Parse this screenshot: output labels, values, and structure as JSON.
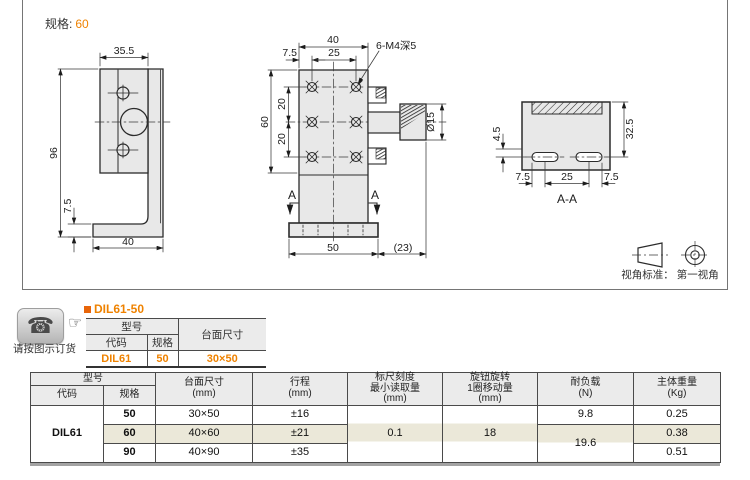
{
  "drawing": {
    "spec_label": "规格:",
    "spec_value": "60",
    "thread_note": "6-M4深5",
    "section_marker": "A",
    "section_label": "A-A",
    "projection_note": "视角标准： 第一视角",
    "dims": {
      "lv_width": "35.5",
      "lv_height": "96",
      "lv_base_th": "7.5",
      "lv_base_w": "40",
      "fv_width": "40",
      "fv_pitch_x": "25",
      "fv_edge": "7.5",
      "fv_height": "60",
      "fv_pitch_y1": "20",
      "fv_pitch_y2": "20",
      "fv_base": "50",
      "fv_knob_ext": "(23)",
      "fv_knob_dia": "Ø15",
      "sv_height": "32.5",
      "sv_offset": "4.5",
      "sv_left": "7.5",
      "sv_pitch": "25",
      "sv_right": "7.5"
    }
  },
  "order": {
    "caption": "请按图示订货",
    "title": "DIL61-50",
    "table": {
      "model": "型号",
      "code": "代码",
      "spec": "规格",
      "size": "台面尺寸",
      "code_value": "DIL61",
      "spec_value": "50",
      "size_value": "30×50"
    }
  },
  "spec_table": {
    "headers": {
      "model": "型号",
      "code": "代码",
      "spec": "规格",
      "size_l1": "台面尺寸",
      "size_l2": "(mm)",
      "travel_l1": "行程",
      "travel_l2": "(mm)",
      "scale_l1": "标尺刻度",
      "scale_l2": "最小读取量",
      "scale_l3": "(mm)",
      "knob_l1": "旋钮旋转",
      "knob_l2": "1圈移动量",
      "knob_l3": "(mm)",
      "load_l1": "耐负载",
      "load_l2": "(N)",
      "weight_l1": "主体重量",
      "weight_l2": "(Kg)"
    },
    "code_value": "DIL61",
    "rows": [
      {
        "spec": "50",
        "size": "30×50",
        "travel": "±16",
        "weight": "0.25"
      },
      {
        "spec": "60",
        "size": "40×60",
        "travel": "±21",
        "weight": "0.38"
      },
      {
        "spec": "90",
        "size": "40×90",
        "travel": "±35",
        "weight": "0.51"
      }
    ],
    "scale_value": "0.1",
    "knob_value": "18",
    "load_value_1": "9.8",
    "load_value_23": "19.6"
  },
  "colors": {
    "accent": "#ef8200",
    "highlight": "#ebe8d9",
    "header_bg": "#ebebeb"
  }
}
